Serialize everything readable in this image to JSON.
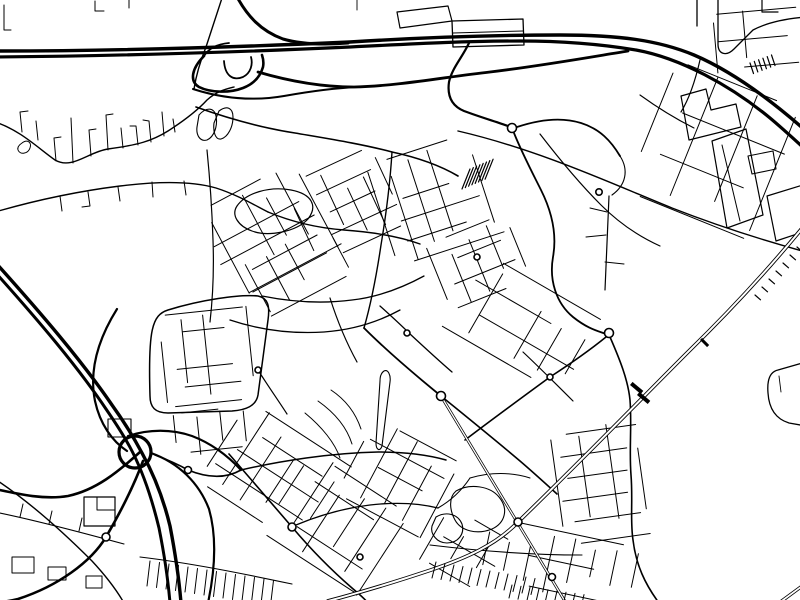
{
  "meta": {
    "title": "black-and-white-city-street-map",
    "background": "#ffffff",
    "ink": "#000000",
    "width": 800,
    "height": 600
  },
  "map": {
    "grid_stroke": 1.0,
    "grids": [
      {
        "cx": 262,
        "cy": 232,
        "a": -28,
        "w": 120,
        "h": 95,
        "nx": 7,
        "ny": 6
      },
      {
        "cx": 345,
        "cy": 205,
        "a": -25,
        "w": 95,
        "h": 85,
        "nx": 6,
        "ny": 5
      },
      {
        "cx": 432,
        "cy": 200,
        "a": -18,
        "w": 105,
        "h": 105,
        "nx": 6,
        "ny": 6
      },
      {
        "cx": 478,
        "cy": 262,
        "a": -22,
        "w": 85,
        "h": 70,
        "nx": 5,
        "ny": 4
      },
      {
        "cx": 298,
        "cy": 268,
        "a": -28,
        "w": 90,
        "h": 60,
        "nx": 5,
        "ny": 3
      },
      {
        "cx": 207,
        "cy": 357,
        "a": -6,
        "w": 88,
        "h": 92,
        "nx": 5,
        "ny": 6
      },
      {
        "cx": 210,
        "cy": 430,
        "a": -6,
        "w": 70,
        "h": 40,
        "nx": 4,
        "ny": 3
      },
      {
        "cx": 272,
        "cy": 472,
        "a": 33,
        "w": 115,
        "h": 95,
        "nx": 6,
        "ny": 5
      },
      {
        "cx": 335,
        "cy": 523,
        "a": 33,
        "w": 115,
        "h": 95,
        "nx": 6,
        "ny": 5
      },
      {
        "cx": 398,
        "cy": 478,
        "a": 28,
        "w": 95,
        "h": 85,
        "nx": 5,
        "ny": 5
      },
      {
        "cx": 520,
        "cy": 322,
        "a": 30,
        "w": 130,
        "h": 85,
        "nx": 6,
        "ny": 4
      },
      {
        "cx": 600,
        "cy": 485,
        "a": -8,
        "w": 85,
        "h": 110,
        "nx": 4,
        "ny": 6
      },
      {
        "cx": 560,
        "cy": 562,
        "a": 12,
        "w": 150,
        "h": 60,
        "nx": 8,
        "ny": 3
      },
      {
        "cx": 712,
        "cy": 150,
        "a": 22,
        "w": 130,
        "h": 140,
        "nx": 4,
        "ny": 4
      },
      {
        "cx": 470,
        "cy": 552,
        "a": 30,
        "w": 80,
        "h": 60,
        "nx": 4,
        "ny": 3
      },
      {
        "cx": 760,
        "cy": 38,
        "a": -5,
        "w": 90,
        "h": 55,
        "nx": 4,
        "ny": 3
      }
    ],
    "roads": [
      {
        "d": "M 469,43 C 462,58 452,68 449,82 C 447,96 452,106 464,111 C 480,117 497,122 508,126",
        "w": 2.2
      },
      {
        "d": "M 517,127 C 541,119 562,117 581,123 C 600,129 611,141 620,156",
        "w": 1.8
      },
      {
        "d": "M 514,133 C 522,153 532,172 541,190 C 552,212 557,235 553,257 C 549,280 556,303 573,317 C 588,329 598,331 606,334",
        "w": 1.8
      },
      {
        "d": "M 196,107 C 230,119 262,128 295,133 C 330,139 362,144 392,152 C 420,158 441,166 458,176",
        "w": 1.6
      },
      {
        "d": "M -5,122 C 20,130 38,148 55,160 C 72,170 88,152 108,149 C 138,145 152,141 168,131 C 182,122 196,112 207,100 C 217,91 226,89 234,87",
        "w": 1.4
      },
      {
        "d": "M -5,212 C 40,199 80,191 120,186 C 160,181 192,181 216,188 C 238,195 256,206 268,212",
        "w": 1.4
      },
      {
        "d": "M 207,150 C 210,180 212,210 213,240 C 214,268 213,296 210,322",
        "w": 1.2
      },
      {
        "d": "M 458,131 C 540,150 615,185 672,208 C 718,226 762,240 806,252",
        "w": 1.4
      },
      {
        "d": "M 392,152 C 390,185 386,215 381,245 C 377,272 372,300 364,328",
        "w": 1.4
      },
      {
        "d": "M 364,328 C 388,352 414,374 441,396",
        "w": 1.8
      },
      {
        "d": "M 441,396 C 468,418 494,439 520,461 C 534,473 546,484 557,494",
        "w": 1.6
      },
      {
        "d": "M 606,337 C 590,350 570,364 550,377 C 524,396 494,418 465,440",
        "w": 1.6
      },
      {
        "d": "M 610,337 C 620,360 628,380 630,400 C 632,425 629,450 631,475 C 633,500 630,520 633,540 C 636,565 645,584 659,603",
        "w": 1.6
      },
      {
        "d": "M 229,454 C 250,478 272,504 292,527 C 314,553 337,575 352,588 C 359,594 364,598 368,603",
        "w": 1.6
      },
      {
        "d": "M 241,470 C 280,461 330,453 378,452 C 408,452 428,455 446,460",
        "w": 1.5
      },
      {
        "d": "M 155,455 C 171,461 181,466 188,470 C 210,479 227,478 241,470",
        "w": 1.6
      },
      {
        "d": "M 296,525 C 320,515 345,508 370,505 C 396,502 418,503 438,508",
        "w": 1.3
      },
      {
        "d": "M -5,479 C 30,502 62,531 92,561 C 105,575 116,589 124,603",
        "w": 1.4
      },
      {
        "d": "M -5,512 C 35,520 80,532 124,544",
        "w": 1.1
      },
      {
        "d": "M 523,352 C 540,368 557,385 573,401",
        "w": 1.2
      },
      {
        "d": "M 438,508 C 452,500 462,490 470,478",
        "w": 1.1
      },
      {
        "d": "M 268,212 C 292,222 318,228 344,230 C 372,232 398,236 420,244",
        "w": 1.4
      },
      {
        "d": "M 262,296 C 292,302 322,304 352,300 C 378,297 402,288 424,276",
        "w": 1.3
      },
      {
        "d": "M 230,320 C 260,330 292,334 324,332 C 352,330 378,322 400,310",
        "w": 1.3
      },
      {
        "d": "M 700,60 C 695,82 689,99 681,112",
        "w": 1.2
      },
      {
        "d": "M 540,134 C 560,160 580,184 601,205 C 620,224 640,237 660,246",
        "w": 1.2
      },
      {
        "d": "M 806,362 L 778,370 C 769,372 767,381 768,393 C 769,409 776,419 789,423 L 806,426",
        "w": 1.3
      },
      {
        "d": "M 140,557 C 190,563 240,573 292,584",
        "w": 1.1
      },
      {
        "d": "M 430,545 C 480,551 530,555 582,555",
        "w": 1.1
      },
      {
        "d": "M 330,298 C 337,320 346,342 357,362",
        "w": 1.2
      },
      {
        "d": "M 697,-4 L 697,26",
        "w": 1.3
      },
      {
        "d": "M 718,-4 L 718,44 C 718,54 726,57 734,49 L 753,30 C 766,23 782,19 806,17",
        "w": 1.3
      },
      {
        "d": "M 762,-4 L 762,12 L 778,12",
        "w": 1.2
      },
      {
        "d": "M 95,1 L 95,11 L 104,11",
        "w": 1.0
      },
      {
        "d": "M 129,-2 L 129,8",
        "w": 1.0
      },
      {
        "d": "M 4,5 L 4,30 L 11,30",
        "w": 1.0
      },
      {
        "d": "M 609,196 L 605,290",
        "w": 1.2
      },
      {
        "d": "M 620,156 C 629,170 626,185 612,195",
        "w": 1.1
      },
      {
        "d": "M 258,370 C 268,386 278,400 287,414",
        "w": 1.2
      },
      {
        "d": "M 380,306 C 390,315 400,324 410,334 C 424,347 438,360 452,372",
        "w": 1.3
      },
      {
        "d": "M 223,-5 L 206,47 C 200,62 196,76 194,89",
        "w": 1.4
      },
      {
        "d": "M 470,478 C 490,472 512,472 530,478",
        "w": 1.0
      }
    ],
    "minors": [
      {
        "d": "M 22,132 L 20,112 L 28,111",
        "w": 1.0
      },
      {
        "d": "M 38,140 L 36,121",
        "w": 1.0
      },
      {
        "d": "M 56,161 L 54,138 L 61,137",
        "w": 1.0
      },
      {
        "d": "M 73,163 L 71,118",
        "w": 1.0
      },
      {
        "d": "M 91,156 L 89,130 L 96,129",
        "w": 1.0
      },
      {
        "d": "M 108,150 L 106,115 L 113,114",
        "w": 1.0
      },
      {
        "d": "M 123,148 L 121,128",
        "w": 1.0
      },
      {
        "d": "M 138,145 L 136,126 L 130,126",
        "w": 1.0
      },
      {
        "d": "M 151,142 L 149,121 L 143,120",
        "w": 1.0
      },
      {
        "d": "M 164,136 L 162,112",
        "w": 1.0
      },
      {
        "d": "M 175,132 L 173,119",
        "w": 1.0
      },
      {
        "d": "M 60,196 L 62,211",
        "w": 1.0
      },
      {
        "d": "M 88,192 L 90,206 L 82,207",
        "w": 1.0
      },
      {
        "d": "M 118,187 L 120,201",
        "w": 1.0
      },
      {
        "d": "M 152,182 L 153,197",
        "w": 1.0
      },
      {
        "d": "M 184,181 L 186,195",
        "w": 1.0
      },
      {
        "d": "M 606,235 L 586,237",
        "w": 1.0
      },
      {
        "d": "M 605,262 L 624,264",
        "w": 1.0
      },
      {
        "d": "M 607,212 L 590,208",
        "w": 1.0
      },
      {
        "d": "M 640,95 C 658,108 676,119 694,128",
        "w": 1.1
      },
      {
        "d": "M 722,145 L 740,221",
        "w": 1.0
      },
      {
        "d": "M 453,33 L 523,31",
        "w": 1.0
      },
      {
        "d": "M 97,497 L 97,510 L 115,510",
        "w": 1.0
      },
      {
        "d": "M 20,517 L 23,504",
        "w": 1.0
      },
      {
        "d": "M 49,524 L 52,511",
        "w": 1.0
      },
      {
        "d": "M 79,531 L 82,518",
        "w": 1.0
      },
      {
        "d": "M 331,390 C 346,400 356,414 361,429",
        "w": 1.0
      },
      {
        "d": "M 318,401 C 335,413 347,428 352,444",
        "w": 1.0
      },
      {
        "d": "M 305,413 C 322,427 335,443 340,458",
        "w": 1.0
      },
      {
        "d": "M 779,376 L 781,392",
        "w": 0.9
      },
      {
        "d": "M 357,0 L 357,10",
        "w": 0.9
      }
    ],
    "outlines": [
      {
        "d": "M 712,141 L 746,129 L 763,215 L 727,228 Z",
        "w": 1.2
      },
      {
        "d": "M 767,196 L 806,184 L 806,231 L 776,241 Z",
        "w": 1.2
      },
      {
        "d": "M 681,96 L 706,89 L 711,110 L 736,104 L 741,127 L 689,140 Z",
        "w": 1.2
      },
      {
        "d": "M 748,156 L 773,151 L 776,169 L 752,174 Z",
        "w": 1.1
      },
      {
        "d": "M 452,21 L 523,19 L 524,45 L 453,47 Z",
        "w": 1.3
      },
      {
        "d": "M 397,12 L 448,6 L 452,21 L 400,28 Z",
        "w": 1.2
      },
      {
        "d": "M 84,497 L 115,497 L 115,526 L 84,526 Z",
        "w": 1.2
      },
      {
        "d": "M 108,419 L 131,419 L 131,437 L 108,437 Z",
        "w": 1.1
      },
      {
        "d": "M 12,557 L 34,557 L 34,573 L 12,573 Z",
        "w": 1.0
      },
      {
        "d": "M 48,567 L 66,567 L 66,580 L 48,580 Z",
        "w": 1.0
      },
      {
        "d": "M 86,576 L 102,576 L 102,588 L 86,588 Z",
        "w": 1.0
      },
      {
        "d": "M 384,371 C 381,373 380,377 380,381 L 376,443 C 376,450 380,452 382,446 L 390,382 C 391,375 388,369 384,371 Z",
        "w": 1.1
      },
      {
        "d": "M 456,491 C 470,483 490,486 499,497 C 509,509 505,523 492,529 C 477,535 461,531 455,520 C 450,511 448,498 456,491 Z",
        "w": 1.1
      },
      {
        "d": "M 436,517 C 446,511 458,514 462,524 C 465,534 458,543 447,543 C 437,543 430,534 432,526 Z",
        "w": 1.1
      },
      {
        "d": "M 199,115 C 206,107 214,107 216,116 C 218,126 214,137 207,140 C 200,142 196,135 197,127 Z",
        "w": 1.1
      },
      {
        "d": "M 219,111 C 227,105 233,108 233,117 C 233,127 228,137 221,139 C 215,140 213,131 214,123 Z",
        "w": 1.1
      },
      {
        "d": "M 237,206 C 246,193 269,186 291,190 C 312,194 318,206 308,219 C 296,232 268,237 252,231 C 238,226 231,215 237,206 Z",
        "w": 1.2
      },
      {
        "d": "M 22,143 C 27,139 32,142 30,148 C 28,154 20,155 18,150 C 17,147 19,145 22,143 Z",
        "w": 1.0
      },
      {
        "d": "M 150,396 C 148,330 152,315 168,310 C 200,300 240,294 258,296 C 268,298 270,306 268,320 L 258,395 C 256,406 246,410 232,411 L 168,413 C 155,413 150,407 150,396 Z",
        "w": 1.5
      }
    ],
    "motorways": [
      {
        "d": "M -5,51 C 120,51 240,47 350,42 C 430,37 500,35 560,35 C 618,35 658,40 694,55 C 734,72 772,101 806,131",
        "w": 3.4
      },
      {
        "d": "M -5,57 C 120,56 240,52 350,47 C 428,43 470,41 520,41 C 560,41 600,44 636,50 C 680,58 730,85 770,118 C 782,128 795,140 806,150",
        "w": 3.2
      },
      {
        "d": "M 258,72 C 292,82 322,87 354,87 C 398,86 445,77 490,72 C 540,66 585,58 628,51",
        "w": 2.8
      },
      {
        "d": "M 236,-5 C 247,16 261,31 283,39 C 300,44 322,45 348,43",
        "w": 3.0
      },
      {
        "d": "M -5,262 C 40,312 82,361 112,405 C 125,423 134,438 142,453 C 153,473 163,497 170,526 C 175,552 179,578 181,603",
        "w": 3.4
      },
      {
        "d": "M -5,272 C 38,320 78,367 106,409 C 117,425 126,439 133,453 C 143,473 152,499 159,528 C 164,553 168,579 170,603",
        "w": 3.0
      },
      {
        "d": "M 140,452 C 118,472 96,490 68,496 C 44,500 18,494 -5,489",
        "w": 2.6
      },
      {
        "d": "M 143,461 C 133,488 120,513 106,537 C 91,562 58,586 18,599 C 10,601 3,602 -5,603",
        "w": 2.6
      },
      {
        "d": "M 151,453 C 179,463 199,483 209,509 C 217,537 215,570 208,603",
        "w": 2.2
      },
      {
        "d": "M 128,436 C 149,429 172,429 192,436 C 213,444 228,456 241,470",
        "w": 2.2
      },
      {
        "d": "M 117,309 C 97,341 89,371 95,401 C 100,424 112,441 127,451",
        "w": 2.2
      },
      {
        "d": "M 204,56 C 192,68 189,81 199,87 C 211,93 230,93 243,88 C 256,83 261,74 263,67 C 264,62 263,58 262,55",
        "w": 2.6
      },
      {
        "d": "M 224,61 C 225,76 233,81 243,77 C 251,73 253,64 251,57",
        "w": 1.8
      },
      {
        "d": "M 193,89 C 224,99 255,101 284,96 C 312,91 335,88 358,87",
        "w": 2.0
      },
      {
        "d": "M 204,56 C 209,48 218,44 229,43",
        "w": 1.8
      }
    ],
    "railways": [
      {
        "d": "M 812,216 C 772,266 732,309 688,352 C 642,398 578,464 518,522 C 496,545 466,558 431,570 C 398,581 362,592 328,601",
        "w": 3.8,
        "inner": 2.0
      },
      {
        "d": "M 779,603 L 813,578",
        "w": 3.4,
        "inner": 1.8
      },
      {
        "d": "M 441,396 L 566,603",
        "w": 2.8,
        "inner": 1.3
      }
    ],
    "loops": [
      {
        "cx": 135,
        "cy": 452,
        "r": 16,
        "w": 3.2
      }
    ],
    "hatches": [
      {
        "x": 462,
        "y": 189,
        "sx": 3.3,
        "sy": -1.4,
        "n": 8,
        "lx": 8,
        "ly": -20,
        "w": 1.2
      },
      {
        "x": 755,
        "y": 295,
        "sx": 7,
        "sy": -8,
        "n": 7,
        "lx": 5.5,
        "ly": 4.8,
        "w": 1.2
      },
      {
        "x": 750,
        "y": 63,
        "sx": 4.3,
        "sy": -1.6,
        "n": 6,
        "lx": 3.5,
        "ly": 10.5,
        "w": 1.2
      },
      {
        "x": 150,
        "y": 561,
        "sx": 9.5,
        "sy": 1.5,
        "n": 14,
        "lx": -3,
        "ly": 25,
        "w": 1.0
      },
      {
        "x": 436,
        "y": 562,
        "sx": 9,
        "sy": 1.5,
        "n": 12,
        "lx": -4,
        "ly": 16,
        "w": 1.0
      },
      {
        "x": 512,
        "y": 585,
        "sx": 9,
        "sy": 1.2,
        "n": 9,
        "lx": -3,
        "ly": 13,
        "w": 1.0
      }
    ],
    "marks": [
      {
        "x": 630,
        "y": 385,
        "w": 4,
        "h": 14,
        "a": -50
      },
      {
        "x": 637,
        "y": 395,
        "w": 4,
        "h": 14,
        "a": -50
      },
      {
        "x": 700,
        "y": 340,
        "w": 3,
        "h": 10,
        "a": -45
      }
    ],
    "circles": [
      {
        "cx": 512,
        "cy": 128,
        "r": 4.5
      },
      {
        "cx": 599,
        "cy": 192,
        "r": 3.2
      },
      {
        "cx": 477,
        "cy": 257,
        "r": 3.0
      },
      {
        "cx": 609,
        "cy": 333,
        "r": 4.5
      },
      {
        "cx": 550,
        "cy": 377,
        "r": 3.0
      },
      {
        "cx": 441,
        "cy": 396,
        "r": 4.5
      },
      {
        "cx": 518,
        "cy": 522,
        "r": 4.0
      },
      {
        "cx": 552,
        "cy": 577,
        "r": 3.5
      },
      {
        "cx": 292,
        "cy": 527,
        "r": 4.0
      },
      {
        "cx": 188,
        "cy": 470,
        "r": 3.5
      },
      {
        "cx": 106,
        "cy": 537,
        "r": 4.0
      },
      {
        "cx": 258,
        "cy": 370,
        "r": 3.0
      },
      {
        "cx": 360,
        "cy": 557,
        "r": 3.0
      },
      {
        "cx": 407,
        "cy": 333,
        "r": 3.0
      }
    ]
  }
}
